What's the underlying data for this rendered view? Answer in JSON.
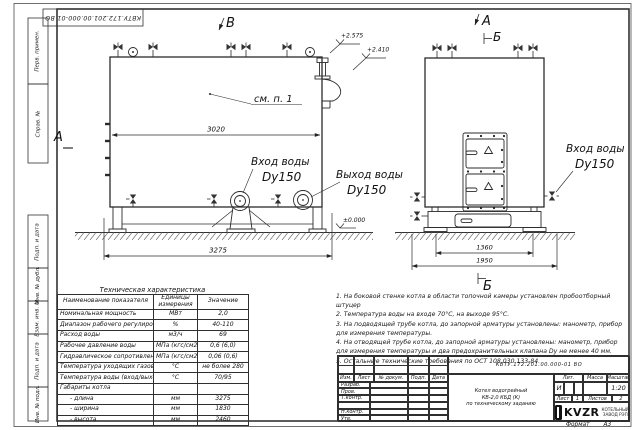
{
  "sheet": {
    "designation": "КВТУ.172.201.00.000-01 ВО",
    "format_label": "Формат",
    "format_value": "А3",
    "side_stamps": {
      "perv_primen": "Перв. примен.",
      "sprav_no": "Справ. №",
      "podp_data_1": "Подп. и дата",
      "inv_dubl": "Инв. № дубл.",
      "vzam_inv": "Взам. инв. №",
      "podp_data_2": "Подп. и дата",
      "inv_podl": "Инв. № подл."
    }
  },
  "drawing": {
    "views": {
      "label_v": "В",
      "label_a_left": "А",
      "label_a_top": "А",
      "label_b_top": "Б",
      "label_b_bottom": "Б"
    },
    "callouts": {
      "see_note": "см. п. 1",
      "inlet_left_line1": "Вход воды",
      "inlet_left_line2": "Dy150",
      "outlet_line1": "Выход воды",
      "outlet_line2": "Dy150",
      "inlet_right_line1": "Вход воды",
      "inlet_right_line2": "Dy150"
    },
    "elevations": {
      "top_outer": "+2.575",
      "top_inner": "+2.410",
      "ground": "±0.000"
    },
    "dimensions": {
      "body_length": "3020",
      "overall_length": "3275",
      "base_width": "1360",
      "overall_width": "1950"
    }
  },
  "spec_table": {
    "title": "Техническая характеристика",
    "col_name": "Наименование показателя",
    "col_units": "Единицы измерения",
    "col_value": "Значение",
    "rows": [
      {
        "name": "Номинальная мощность",
        "units": "МВт",
        "value": "2,0"
      },
      {
        "name": "Диапазон рабочего регулирования",
        "units": "%",
        "value": "40-110"
      },
      {
        "name": "Расход воды",
        "units": "м3/ч",
        "value": "69"
      },
      {
        "name": "Рабочее давление воды",
        "units": "МПа (кгс/см2)",
        "value": "0,6 (6,0)"
      },
      {
        "name": "Гидравлическое сопротивление котла",
        "units": "МПа (кгс/см2)",
        "value": "0,06 (0,6)"
      },
      {
        "name": "Температура уходящих газов",
        "units": "°С",
        "value": "не более 280"
      },
      {
        "name": "Температура воды (вход/выход)",
        "units": "°С",
        "value": "70/95"
      },
      {
        "name": "Габариты котла",
        "units": "",
        "value": ""
      },
      {
        "name": "- длина",
        "units": "мм",
        "value": "3275"
      },
      {
        "name": "- ширина",
        "units": "мм",
        "value": "1830"
      },
      {
        "name": "- высота",
        "units": "мм",
        "value": "2460"
      }
    ]
  },
  "notes": [
    "1.  На боковой стенке котла в области топочной камеры установлен пробоотборный штуцер",
    "2.  Температура воды на входе 70°С, на выходе 95°С.",
    "3.  На подводящей трубе котла, до запорной арматуры установлены: манометр, прибор для измерения температуры.",
    "4.  На отводящей трубе котла, до запорной арматуры установлены: манометр, прибор для измерения температуры и два предохранительных клапана Dy не менее 40 мм.",
    "5.  Остальные технические требования по ОСТ 108.030.133-84."
  ],
  "title_block": {
    "designation": "КВТУ.172.201.00.000-01 ВО",
    "product_line1": "Котел водогрейный",
    "product_line2": "КВ-2,0 КБД (К)",
    "product_line3": "по техническому заданию",
    "cols": {
      "izm": "Изм.",
      "list": "Лист",
      "doc": "№ докум.",
      "podp": "Подп.",
      "data": "Дата"
    },
    "rows": {
      "razrab": "Разраб.",
      "prov": "Пров.",
      "tkontr": "Т.контр.",
      "nkontr": "Н.контр.",
      "utv": "Утв."
    },
    "lit_label": "Лит.",
    "lit_value": "И",
    "massa_label": "Масса",
    "masshtab_label": "Масштаб",
    "masshtab_value": "1:20",
    "list_label": "Лист",
    "list_value": "1",
    "listov_label": "Листов",
    "listov_value": "2",
    "logo_text": "KVZR",
    "logo_sub1": "КОТЕЛЬНЫЙ",
    "logo_sub2": "ЗАВОД РЭП"
  }
}
